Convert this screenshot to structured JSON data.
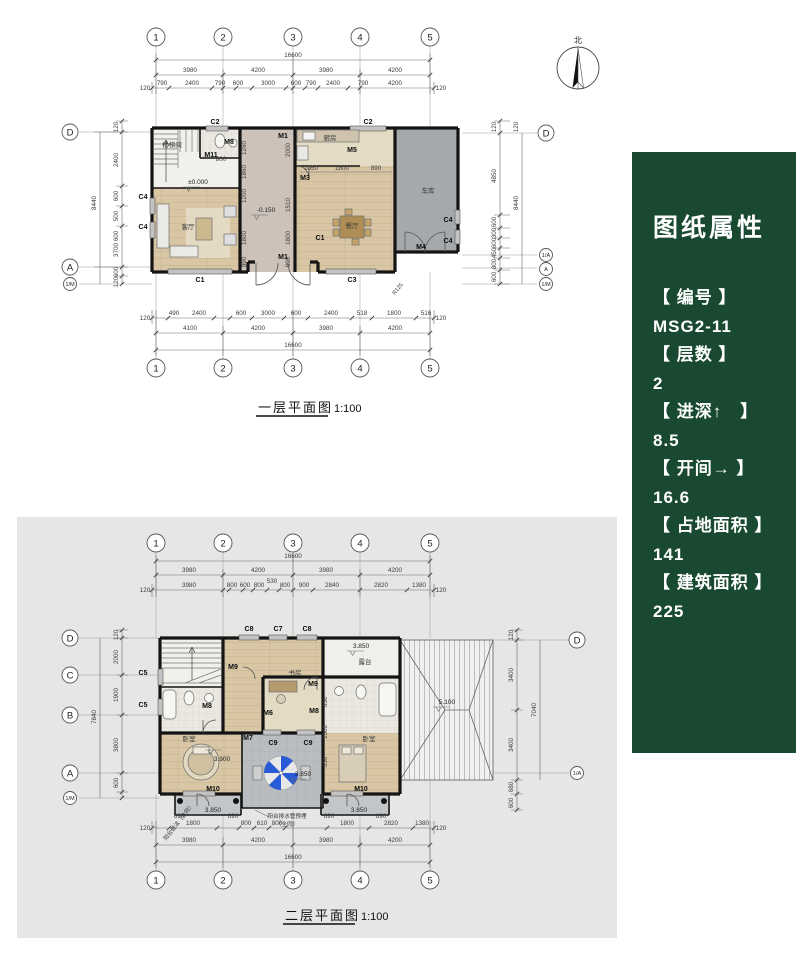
{
  "panel": {
    "title": "图纸属性",
    "items": [
      {
        "label": "【 编号 】",
        "value": "MSG2-11"
      },
      {
        "label": "【 层数 】",
        "value": "2"
      },
      {
        "label": "【 进深↑　】",
        "value": "8.5"
      },
      {
        "label": "【 开间→ 】",
        "value": "16.6"
      },
      {
        "label": "【 占地面积 】",
        "value": "141"
      },
      {
        "label": "【 建筑面积 】",
        "value": "225"
      }
    ],
    "bg_color": "#194a31",
    "text_color": "#ffffff"
  },
  "compass": {
    "north": "北"
  },
  "floor1": {
    "caption": "一层平面图",
    "scale": "1:100",
    "axes": {
      "top": [
        "1",
        "2",
        "3",
        "4",
        "5"
      ],
      "bottom": [
        "1",
        "2",
        "3",
        "4",
        "5"
      ],
      "left": [
        "D",
        "A",
        "1/M"
      ],
      "right": [
        "D",
        "1/A",
        "A",
        "1/M"
      ]
    },
    "dims": {
      "total": "16600",
      "segs": [
        "3980",
        "4200",
        "3980",
        "4200"
      ],
      "top_detail": [
        "790",
        "2400",
        "790",
        "600",
        "3000",
        "600",
        "790",
        "2400",
        "790",
        "4200"
      ],
      "bottom_row": [
        "4100",
        "4200",
        "3980",
        "4200"
      ],
      "bottom_detail": [
        "490",
        "2400",
        "600",
        "3000",
        "600",
        "2400",
        "518",
        "1800",
        "516"
      ],
      "left": [
        "120",
        "2400",
        "600",
        "500",
        "600",
        "3700",
        "600",
        "120"
      ],
      "left_total": "8440",
      "right": [
        "120",
        "4850",
        "600",
        "300",
        "600",
        "450",
        "800",
        "600",
        "120"
      ],
      "right_total": "8440",
      "end120": "120",
      "inner_left": [
        "1260",
        "1860",
        "1200",
        "1800",
        "990"
      ],
      "inner_right": [
        "2000",
        "1510",
        "1800",
        "990"
      ],
      "kitchen": [
        "1050",
        "1800",
        "890"
      ],
      "stair": "800"
    },
    "rooms": {
      "stair": "楼梯间",
      "living": "客厅",
      "dining": "餐厅",
      "kitchen": "厨房",
      "garage": "车库"
    },
    "tags": {
      "c1": "C1",
      "c2": "C2",
      "c3": "C3",
      "c4": "C4",
      "m1": "M1",
      "m3": "M3",
      "m4": "M4",
      "m5": "M5",
      "m8": "M8",
      "m11": "M11"
    },
    "levels": {
      "zero": "±0.000",
      "minus": "-0.150"
    },
    "ann": {
      "r125": "R125"
    }
  },
  "floor2": {
    "caption": "二层平面图",
    "scale": "1:100",
    "axes": {
      "top": [
        "1",
        "2",
        "3",
        "4",
        "5"
      ],
      "bottom": [
        "1",
        "2",
        "3",
        "4",
        "5"
      ],
      "left": [
        "D",
        "C",
        "B",
        "A",
        "1/M"
      ],
      "right": [
        "D",
        "1/A"
      ]
    },
    "dims": {
      "total": "16600",
      "segs": [
        "3980",
        "4200",
        "3980",
        "4200"
      ],
      "top_detail": [
        "3980",
        "800",
        "600",
        "800",
        "530",
        "800",
        "900",
        "2840",
        "2820",
        "1380"
      ],
      "bottom_detail": [
        "1800",
        "800",
        "610",
        "800",
        "1800",
        "2820",
        "1380"
      ],
      "bottom_row": [
        "3980",
        "4200",
        "3980",
        "4200"
      ],
      "left": [
        "2000",
        "1900",
        "3800",
        "600"
      ],
      "left_total": "7840",
      "right": [
        "120",
        "3400",
        "3400",
        "120"
      ],
      "right_total": "7040",
      "right_small": [
        "680",
        "600"
      ],
      "inner": [
        "650",
        "1500",
        "650"
      ],
      "b690": "690",
      "end120": "120"
    },
    "rooms": {
      "bed": "卧室",
      "study": "书房",
      "terrace": "露台"
    },
    "tags": {
      "c5": "C5",
      "c7": "C7",
      "c8": "C8",
      "c9": "C9",
      "m6": "M6",
      "m7": "M7",
      "m8": "M8",
      "m9": "M9",
      "m10": "M10"
    },
    "levels": {
      "l390": "3.900",
      "l385": "3.850",
      "l510": "5.100"
    },
    "ann": {
      "drain1": "阳台排水管预埋",
      "drain2": "（全同）",
      "method": "阳台做法（全同）"
    }
  }
}
